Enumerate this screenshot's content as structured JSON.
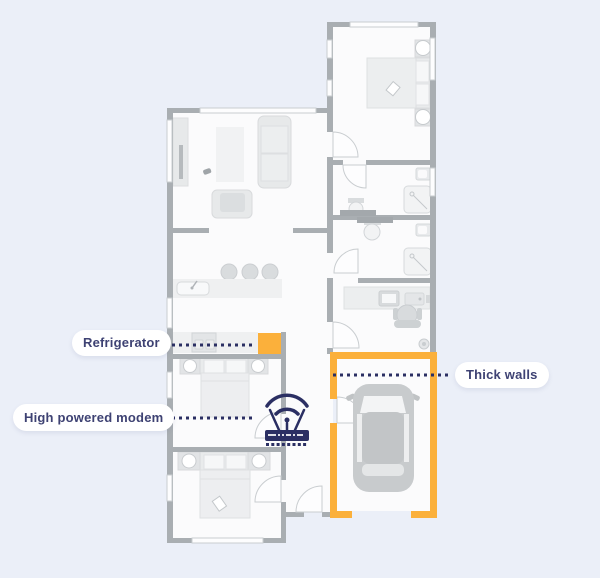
{
  "scene": {
    "description": "Home floor plan illustration showing where to place a high powered modem",
    "background": "#EBEFF8"
  },
  "colors": {
    "accent_yellow": "#FBB03B",
    "navy": "#2B2F63",
    "label_text": "#3E4273",
    "label_bg": "#FFFFFF",
    "wall_gray": "#A9AEB2",
    "room_fill": "#FBFBFC"
  },
  "labels": {
    "refrigerator": "Refrigerator",
    "high_powered_modem": "High powered modem",
    "thick_walls": "Thick walls"
  },
  "icons": {
    "modem": "wifi-router-icon",
    "refrigerator_marker": "refrigerator-square-marker",
    "garage": "thick-walls-highlight-outline",
    "car": "car-top-view"
  }
}
